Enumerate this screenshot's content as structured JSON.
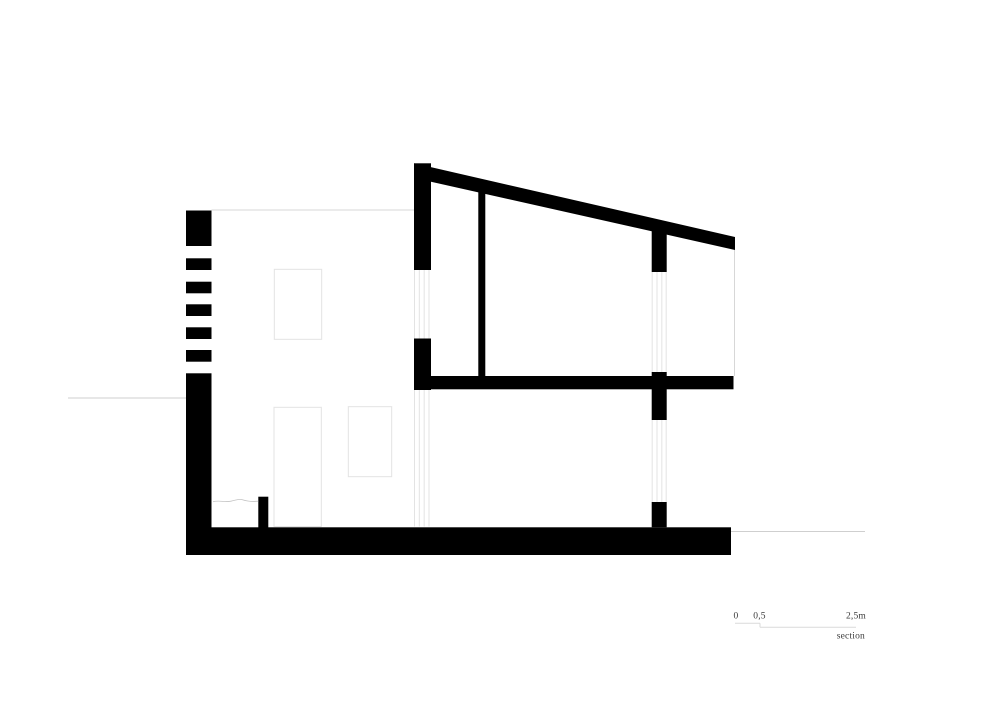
{
  "sheet": {
    "type": "architectural-section-drawing",
    "background": "#ffffff"
  },
  "colors": {
    "ink": "#000000",
    "thin_line": "#d7d7d7",
    "faint_line": "#e3e3e3",
    "ground_line": "#cfcfcf",
    "wavy_line": "#c4c4c4",
    "scale_line": "#dadada",
    "text": "#3b3b3b"
  },
  "scale_bar": {
    "zero": "0",
    "half": "0,5",
    "end": "2,5m",
    "caption": "section",
    "lines": [
      {
        "name": "scale-segment-first",
        "x1": 735,
        "y1": 623.3,
        "x2": 760,
        "y2": 623.3
      },
      {
        "name": "scale-step",
        "x1": 760,
        "y1": 623.3,
        "x2": 760,
        "y2": 627.3
      },
      {
        "name": "scale-segment-rest",
        "x1": 760,
        "y1": 627.3,
        "x2": 856,
        "y2": 627.3
      }
    ]
  },
  "drawing": {
    "solids": [
      {
        "name": "left-wall-cap",
        "x": 186,
        "y": 210.5,
        "w": 25.5,
        "h": 35.5
      },
      {
        "name": "left-wall-hatch-stripe",
        "x": 186,
        "y": 258.3,
        "w": 25.5,
        "h": 11.7
      },
      {
        "name": "left-wall-hatch-stripe",
        "x": 186,
        "y": 281.7,
        "w": 25.5,
        "h": 11.6
      },
      {
        "name": "left-wall-hatch-stripe",
        "x": 186,
        "y": 304.3,
        "w": 25.5,
        "h": 11.7
      },
      {
        "name": "left-wall-hatch-stripe",
        "x": 186,
        "y": 327.3,
        "w": 25.5,
        "h": 11.7
      },
      {
        "name": "left-wall-hatch-stripe",
        "x": 186,
        "y": 350,
        "w": 25.5,
        "h": 11.7
      },
      {
        "name": "left-wall-base",
        "x": 186,
        "y": 373.3,
        "w": 25.5,
        "h": 181.7
      },
      {
        "name": "ground-slab",
        "x": 186,
        "y": 527.3,
        "w": 545,
        "h": 27.7
      },
      {
        "name": "floor-curb",
        "x": 258.3,
        "y": 496.7,
        "w": 10,
        "h": 31
      },
      {
        "name": "upper-wall-left-top",
        "x": 414,
        "y": 163.3,
        "w": 17,
        "h": 106.7
      },
      {
        "name": "upper-wall-left-mid",
        "x": 414,
        "y": 338.5,
        "w": 17,
        "h": 51.5
      },
      {
        "name": "interior-wall",
        "x": 478.3,
        "y": 192,
        "w": 7,
        "h": 184
      },
      {
        "name": "mid-floor-slab",
        "x": 414,
        "y": 376,
        "w": 319.5,
        "h": 13.3
      },
      {
        "name": "right-wall-top",
        "x": 651.7,
        "y": 231,
        "w": 15,
        "h": 41
      },
      {
        "name": "right-wall-mid",
        "x": 651.7,
        "y": 372,
        "w": 15,
        "h": 48
      },
      {
        "name": "right-wall-base",
        "x": 651.7,
        "y": 502,
        "w": 15,
        "h": 25.3
      }
    ],
    "polygons": [
      {
        "name": "roof-slab",
        "points": "414,163.3 735,237 735,250 431,181.7"
      }
    ],
    "thin_lines": [
      {
        "name": "left-volume-roofline",
        "x1": 211.5,
        "y1": 210,
        "x2": 414,
        "y2": 210,
        "color_key": "thin_line"
      },
      {
        "name": "ground-line-left",
        "x1": 68,
        "y1": 398,
        "x2": 186,
        "y2": 398,
        "color_key": "ground_line"
      },
      {
        "name": "ground-line-right",
        "x1": 731,
        "y1": 531.5,
        "x2": 865,
        "y2": 531.5,
        "color_key": "ground_line"
      },
      {
        "name": "right-facade-edge",
        "x1": 734.5,
        "y1": 250,
        "x2": 734.5,
        "y2": 376,
        "color_key": "thin_line"
      }
    ],
    "glazing_groups": [
      {
        "name": "upper-left-window-glazing",
        "xs": [
          414.5,
          419.3,
          424.2,
          429
        ],
        "y1": 270,
        "y2": 338.5
      },
      {
        "name": "lower-left-window-glazing",
        "xs": [
          414.5,
          419.3,
          424.2,
          429
        ],
        "y1": 390,
        "y2": 526.5
      },
      {
        "name": "upper-right-window-glazing",
        "xs": [
          652.2,
          657,
          661.8,
          666.2
        ],
        "y1": 272,
        "y2": 372
      },
      {
        "name": "lower-right-window-glazing",
        "xs": [
          652.2,
          657,
          661.8,
          666.2
        ],
        "y1": 420,
        "y2": 502
      }
    ],
    "elevation_openings": [
      {
        "name": "window-elevation-upper",
        "x": 274.3,
        "y": 269.3,
        "w": 47.4,
        "h": 70
      },
      {
        "name": "door-elevation",
        "x": 274,
        "y": 407.3,
        "w": 47.3,
        "h": 119.2
      },
      {
        "name": "window-elevation-lower",
        "x": 348.3,
        "y": 406.7,
        "w": 43.4,
        "h": 70
      }
    ],
    "freehand_paths": [
      {
        "name": "terrain-break-line",
        "d": "M213,501.8 C219,499.9 225,502.6 231,501.2 C236,500.1 239,498.6 242,499.6 C246,500.9 252,501.9 258.3,501.2"
      }
    ]
  }
}
